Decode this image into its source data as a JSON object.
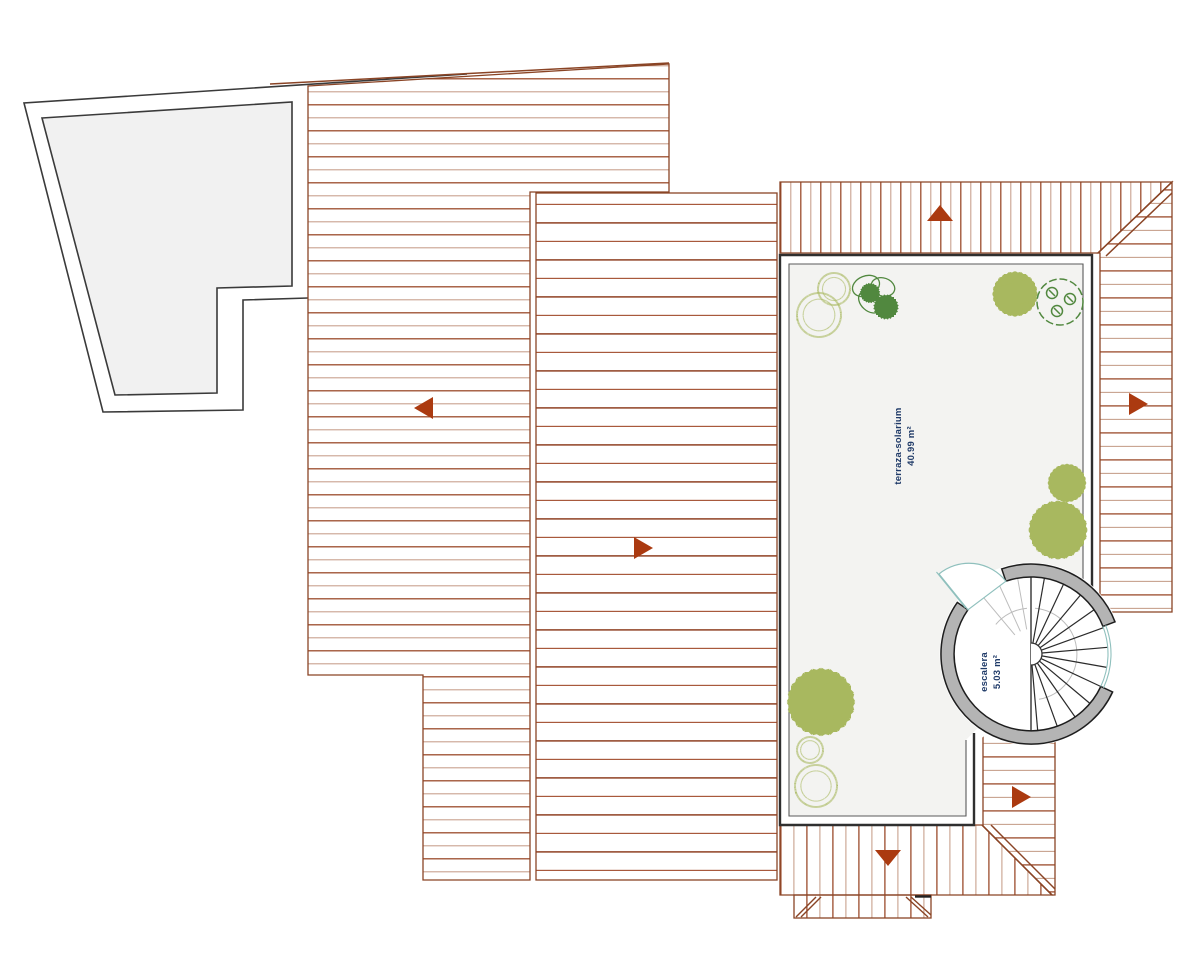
{
  "plan": {
    "rooms": [
      {
        "name": "terraza-solarium",
        "area": "40.99 m²"
      },
      {
        "name": "escalera",
        "area": "5.03 m²"
      }
    ]
  },
  "palette": {
    "hatch_dark": "#9b4b2b",
    "hatch_light": "#c8a18d",
    "hatch_dark_b": "#8f4023",
    "hatch_mid_b": "#a8593c",
    "outline_brown": "#8a4425",
    "slope_arrow": "#ab3a10",
    "site_outline": "#3a3a3a",
    "terrace_border": "#2f2f2f",
    "terrace_fill": "#f3f3f1",
    "polygon_fill": "#f1f1f1",
    "stair_ring": "#b4b4b4",
    "door_teal": "#8fc0bd",
    "plant_olive": "#a8b85f",
    "plant_green": "#51883f",
    "label_text": "#1f3a68"
  },
  "symbols": {
    "slope_arrows": [
      "left",
      "right",
      "up",
      "right",
      "right",
      "down"
    ]
  }
}
